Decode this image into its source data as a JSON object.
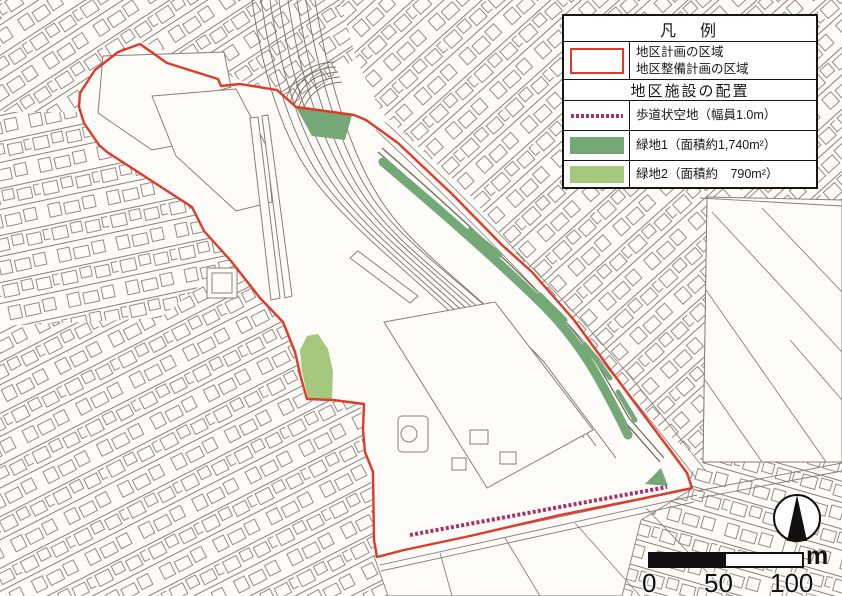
{
  "legend": {
    "title": "凡　例",
    "area_item": {
      "line1": "地区計画の区域",
      "line2": "地区整備計画の区域"
    },
    "section_title": "地区施設の配置",
    "items": [
      {
        "id": "walkway",
        "label": "歩道状空地（幅員1.0m）"
      },
      {
        "id": "green1",
        "label": "緑地1（面積約1,740m²）"
      },
      {
        "id": "green2",
        "label": "緑地2（面積約　790m²）"
      }
    ]
  },
  "scale_bar": {
    "tick0": "0",
    "tick50": "50",
    "tick100": "100",
    "unit": "m"
  },
  "colors": {
    "boundary_red": "#e03a28",
    "green_area_1": "#74a877",
    "green_area_2": "#a5c87e",
    "walkway_magenta": "#a93265",
    "map_line": "#8d7d76",
    "background": "#fdfcf8"
  }
}
